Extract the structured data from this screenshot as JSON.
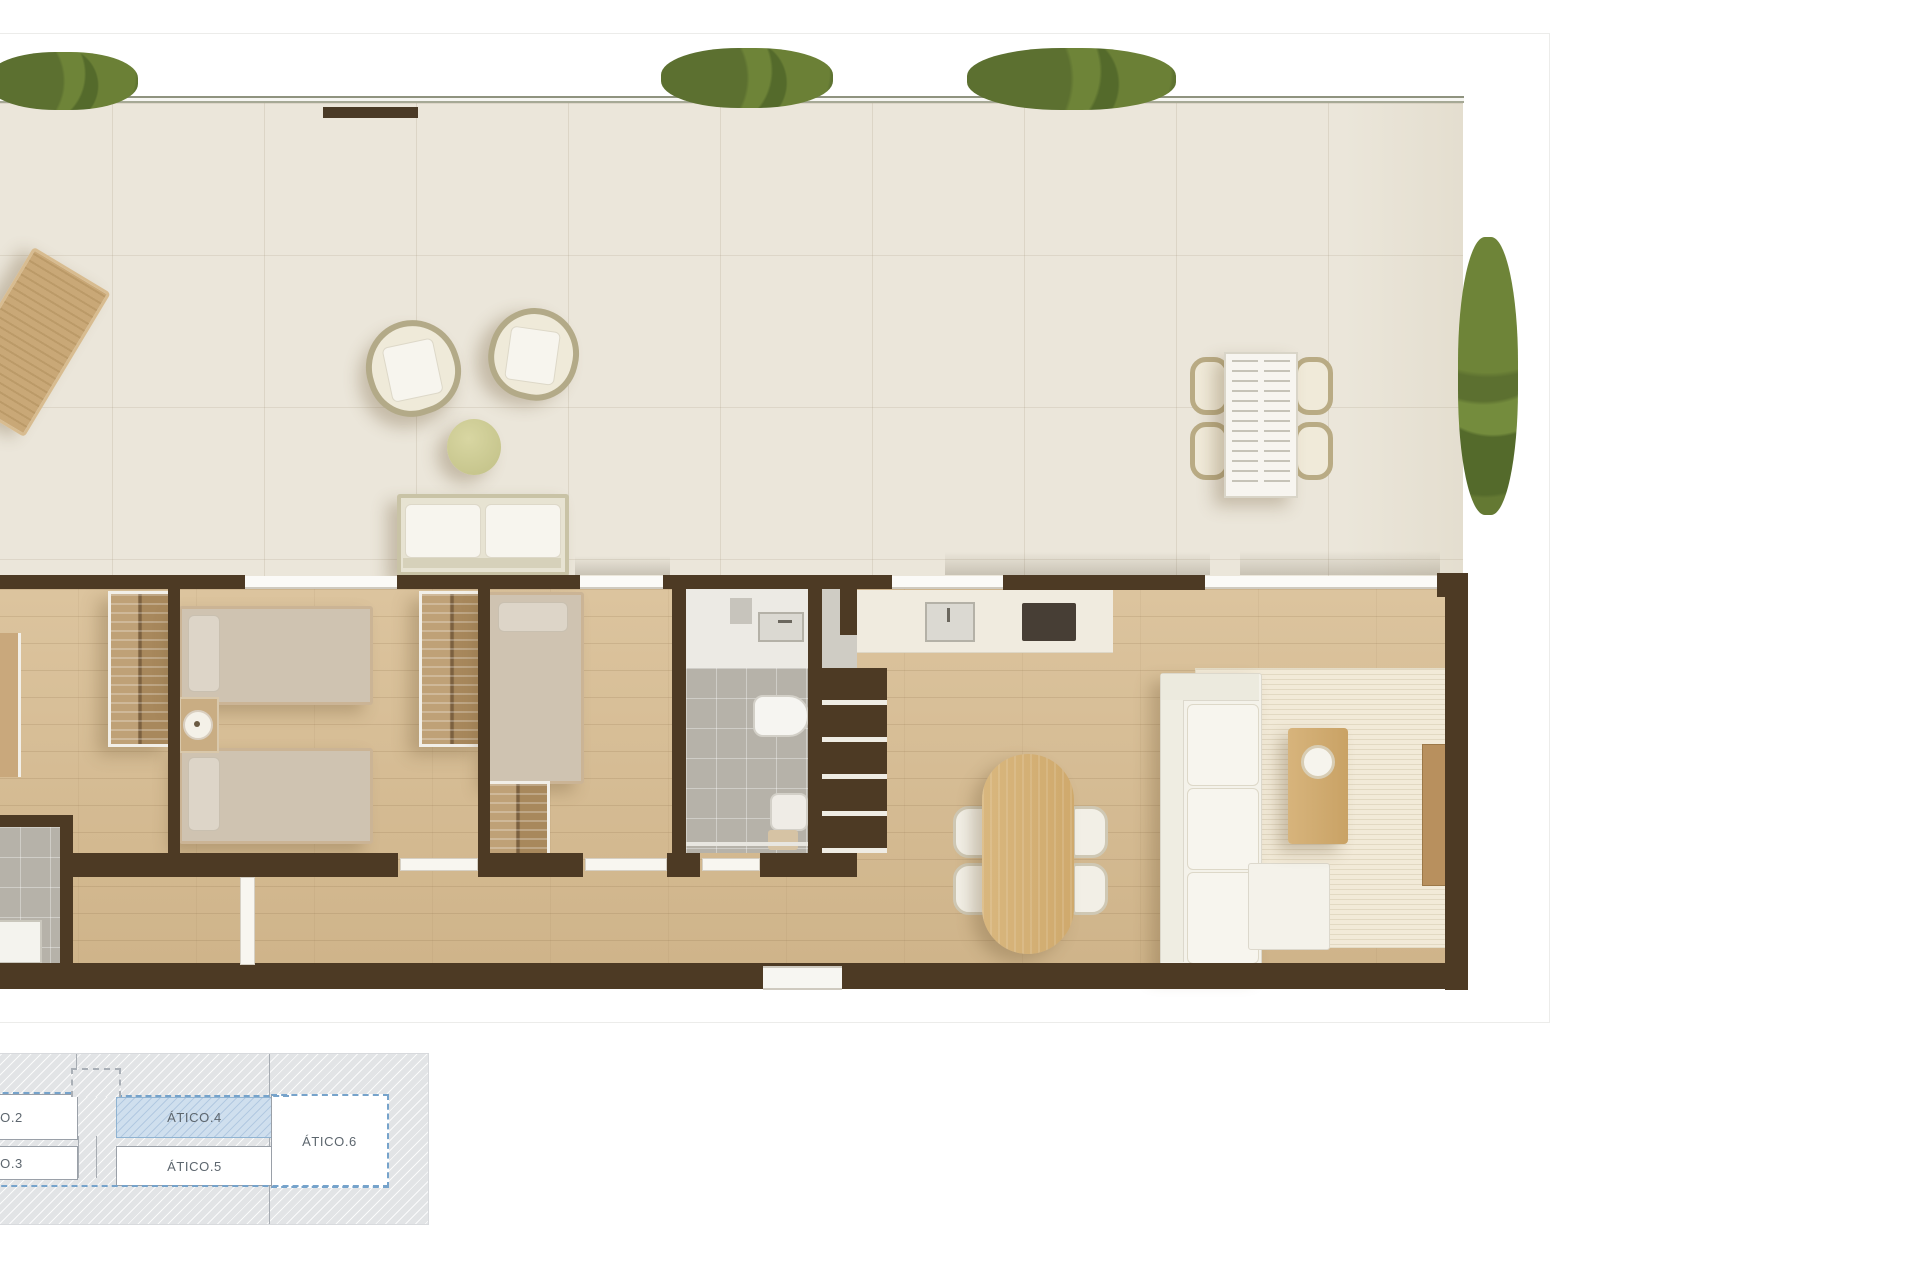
{
  "keyplan": {
    "units": [
      {
        "id": "atico2",
        "label": "ÁTICO.2",
        "highlighted": false
      },
      {
        "id": "atico3",
        "label": "ÁTICO.3",
        "highlighted": false
      },
      {
        "id": "atico4",
        "label": "ÁTICO.4",
        "highlighted": true
      },
      {
        "id": "atico5",
        "label": "ÁTICO.5",
        "highlighted": false
      },
      {
        "id": "atico6",
        "label": "ÁTICO.6",
        "highlighted": false
      }
    ],
    "highlight_fill": "#cfdfee",
    "highlight_border": "#76a3cb",
    "label_color": "#5d666e"
  },
  "floorplan": {
    "colors": {
      "wall": "#4d3a24",
      "wood_floor": "#d6bd97",
      "terrace_tile": "#eae5d9",
      "bath_tile": "#b6b2a9",
      "hedge_green": "#647933",
      "olive_table": "#cdcc96",
      "rug": "#f2ead8"
    }
  }
}
